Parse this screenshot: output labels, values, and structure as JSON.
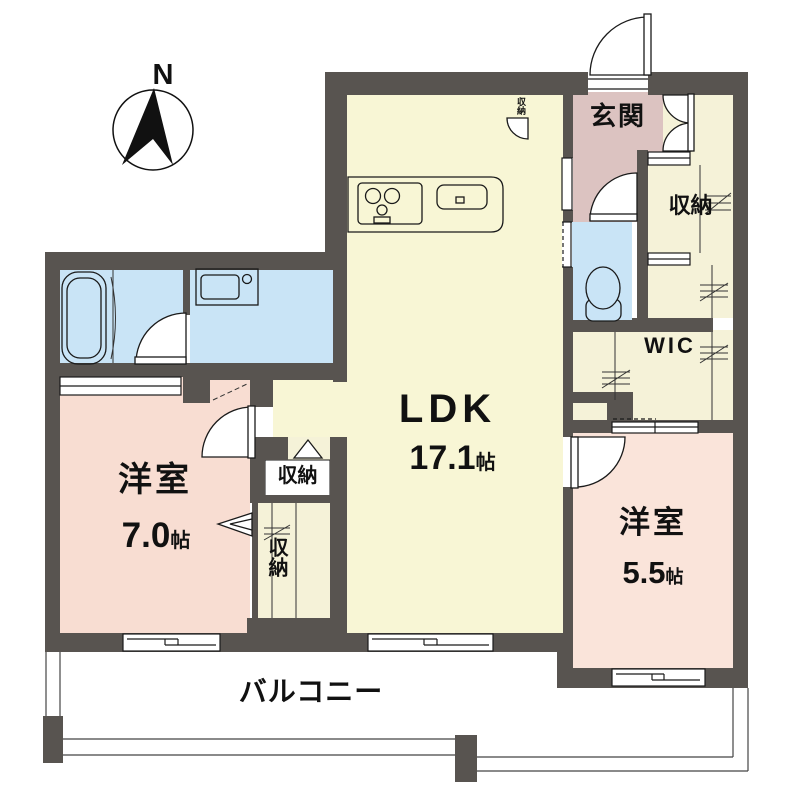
{
  "compass": {
    "label": "N"
  },
  "rooms": {
    "ldk": {
      "label": "LDK",
      "size": "17.1",
      "unit": "帖"
    },
    "bedroom_7": {
      "label": "洋室",
      "size": "7.0",
      "unit": "帖"
    },
    "bedroom_5_5": {
      "label": "洋室",
      "size": "5.5",
      "unit": "帖"
    },
    "entrance": {
      "label": "玄関"
    },
    "wic": {
      "label": "WIC"
    },
    "balcony": {
      "label": "バルコニー"
    }
  },
  "closets": {
    "kitchen_pantry": {
      "label": "収納"
    },
    "entrance_closet": {
      "label": "収納"
    },
    "hall_closet_upper": {
      "label": "収納"
    },
    "hall_closet_lower": {
      "label": "収納"
    }
  },
  "colors": {
    "wall": "#585450",
    "ldk_floor": "#f8f6d5",
    "bedroom7_floor": "#f8ddd2",
    "bedroom5_floor": "#fae4da",
    "entrance_floor": "#dcc3c1",
    "wet_area_floor": "#c9e4f6",
    "closet_floor": "#f5f2d8",
    "line": "#1a1a1a"
  }
}
